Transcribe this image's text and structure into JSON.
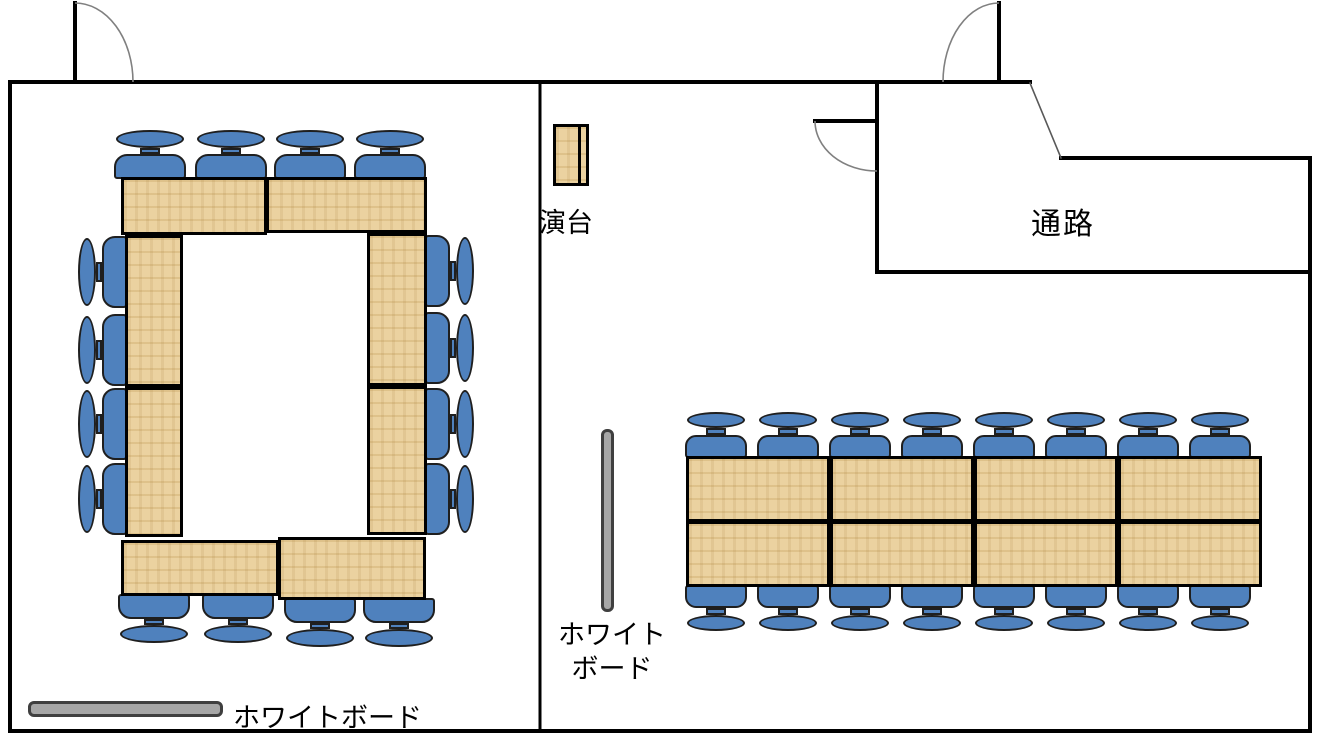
{
  "labels": {
    "podium": "演台",
    "corridor": "通路",
    "whiteboard_room_a": "ホワイトボード",
    "whiteboard_room_b_line1": "ホワイト",
    "whiteboard_room_b_line2": "ボード"
  },
  "colors": {
    "background": "#ffffff",
    "wall": "#000000",
    "door_arc": "#808080",
    "chair_fill": "#4f81bd",
    "chair_border": "#1f1f1f",
    "table_fill": "#eacf9a",
    "table_border": "#000000",
    "whiteboard_fill": "#a6a6a6",
    "whiteboard_border": "#3f3f3f"
  },
  "floorplan": {
    "canvas": {
      "width": 1321,
      "height": 745
    },
    "rooms": [
      {
        "name": "meeting-room-a",
        "layout": "square-ring (ro-no-ji) table arrangement",
        "seats": 16
      },
      {
        "name": "meeting-room-b",
        "layout": "two parallel table rows",
        "seats": 16
      },
      {
        "name": "corridor",
        "label": "通路"
      }
    ],
    "walls": [
      [
        10,
        82,
        1030,
        82,
        4
      ],
      [
        10,
        82,
        10,
        731,
        4
      ],
      [
        10,
        731,
        1310,
        731,
        4
      ],
      [
        1310,
        158,
        1310,
        731,
        4
      ],
      [
        1061,
        158,
        1310,
        158,
        4
      ],
      [
        540,
        82,
        540,
        731,
        3
      ],
      [
        877,
        82,
        877,
        272,
        4
      ],
      [
        877,
        272,
        1310,
        272,
        4
      ]
    ],
    "thin_lines": [
      [
        1030,
        83,
        1061,
        158
      ]
    ],
    "doors": [
      {
        "leaf": [
          75,
          3,
          75,
          82
        ],
        "arc": "M 75 3 A 58 79 0 0 1 133 82"
      },
      {
        "leaf": [
          999,
          3,
          999,
          82
        ],
        "arc": "M 999 3 A 56 79 0 0 0 943 82"
      },
      {
        "leaf": [
          815,
          121,
          877,
          121
        ],
        "arc": "M 815 121 A 62 50 0 0 0 877 171"
      }
    ],
    "tables": [
      [
        121,
        177,
        146,
        58
      ],
      [
        266,
        177,
        161,
        56
      ],
      [
        125,
        235,
        58,
        152
      ],
      [
        125,
        387,
        58,
        150
      ],
      [
        367,
        233,
        60,
        153
      ],
      [
        367,
        386,
        60,
        149
      ],
      [
        121,
        540,
        158,
        56
      ],
      [
        278,
        537,
        148,
        63
      ],
      [
        686,
        456,
        144,
        66
      ],
      [
        830,
        456,
        144,
        66
      ],
      [
        974,
        456,
        144,
        66
      ],
      [
        1118,
        456,
        144,
        66
      ],
      [
        686,
        521,
        144,
        66
      ],
      [
        830,
        521,
        144,
        66
      ],
      [
        974,
        521,
        144,
        66
      ],
      [
        1118,
        521,
        144,
        66
      ]
    ],
    "podium": {
      "x": 553,
      "y": 124,
      "w": 36,
      "h": 62
    },
    "whiteboards": [
      {
        "x": 28,
        "y": 701,
        "w": 195,
        "h": 16,
        "room": "meeting-room-a"
      },
      {
        "x": 601,
        "y": 429,
        "w": 13,
        "h": 183,
        "room": "meeting-room-b"
      }
    ],
    "chairs": [
      [
        150,
        179,
        "u",
        "a"
      ],
      [
        231,
        179,
        "u",
        "a"
      ],
      [
        310,
        179,
        "u",
        "a"
      ],
      [
        390,
        179,
        "u",
        "a"
      ],
      [
        154,
        594,
        "d",
        "a"
      ],
      [
        238,
        594,
        "d",
        "a"
      ],
      [
        320,
        598,
        "d",
        "a"
      ],
      [
        399,
        598,
        "d",
        "a"
      ],
      [
        127,
        272,
        "l",
        "a"
      ],
      [
        127,
        350,
        "l",
        "a"
      ],
      [
        127,
        424,
        "l",
        "a"
      ],
      [
        127,
        499,
        "l",
        "a"
      ],
      [
        425,
        271,
        "r",
        "a"
      ],
      [
        425,
        348,
        "r",
        "a"
      ],
      [
        425,
        424,
        "r",
        "a"
      ],
      [
        425,
        499,
        "r",
        "a"
      ],
      [
        716,
        458,
        "u",
        "b"
      ],
      [
        788,
        458,
        "u",
        "b"
      ],
      [
        860,
        458,
        "u",
        "b"
      ],
      [
        932,
        458,
        "u",
        "b"
      ],
      [
        1004,
        458,
        "u",
        "b"
      ],
      [
        1076,
        458,
        "u",
        "b"
      ],
      [
        1148,
        458,
        "u",
        "b"
      ],
      [
        1220,
        458,
        "u",
        "b"
      ],
      [
        716,
        585,
        "d",
        "b"
      ],
      [
        788,
        585,
        "d",
        "b"
      ],
      [
        860,
        585,
        "d",
        "b"
      ],
      [
        932,
        585,
        "d",
        "b"
      ],
      [
        1004,
        585,
        "d",
        "b"
      ],
      [
        1076,
        585,
        "d",
        "b"
      ],
      [
        1148,
        585,
        "d",
        "b"
      ],
      [
        1220,
        585,
        "d",
        "b"
      ]
    ]
  }
}
